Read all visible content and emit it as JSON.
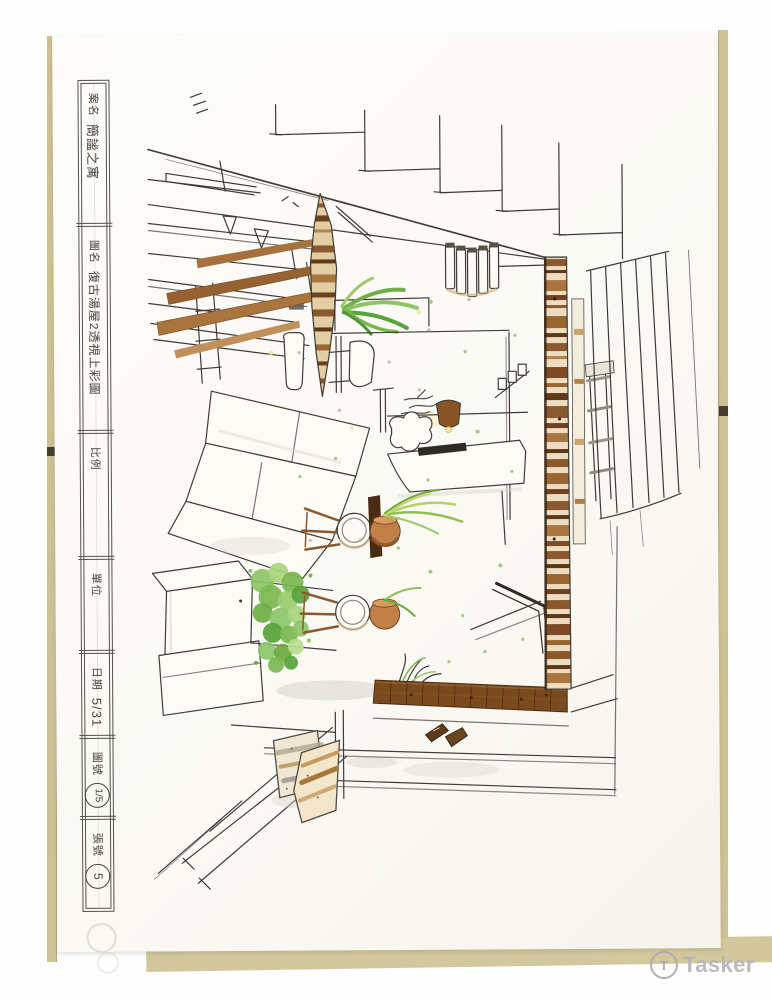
{
  "title_block": {
    "fields": [
      {
        "label": "案名",
        "value": "簡謐之寓"
      },
      {
        "label": "圖名",
        "value": "復古湯屋2透視上彩圖"
      },
      {
        "label": "比例",
        "value": ""
      },
      {
        "label": "單位",
        "value": ""
      },
      {
        "label": "日期",
        "value": "5/31"
      },
      {
        "label": "圖號",
        "value": "1/5"
      },
      {
        "label": "張號",
        "value": "5"
      }
    ]
  },
  "watermark": {
    "text": "Tasker",
    "logo_letter": "T"
  },
  "palette": {
    "paper": "#fcfbf7",
    "board": "#cdc296",
    "ink": "#3f3c37",
    "wood_light": "#d9b98a",
    "wood_mid": "#a6713c",
    "wood_dark": "#6e4120",
    "floor_brown": "#7a4a1f",
    "terracotta": "#c08048",
    "green_light": "#b7dd90",
    "green_mid": "#7ab84e",
    "green_dark": "#57a33c",
    "gray_wash": "#cfccc4",
    "pillow_tan": "#c59a5e",
    "watermark_gray": "#b6b6b6"
  }
}
